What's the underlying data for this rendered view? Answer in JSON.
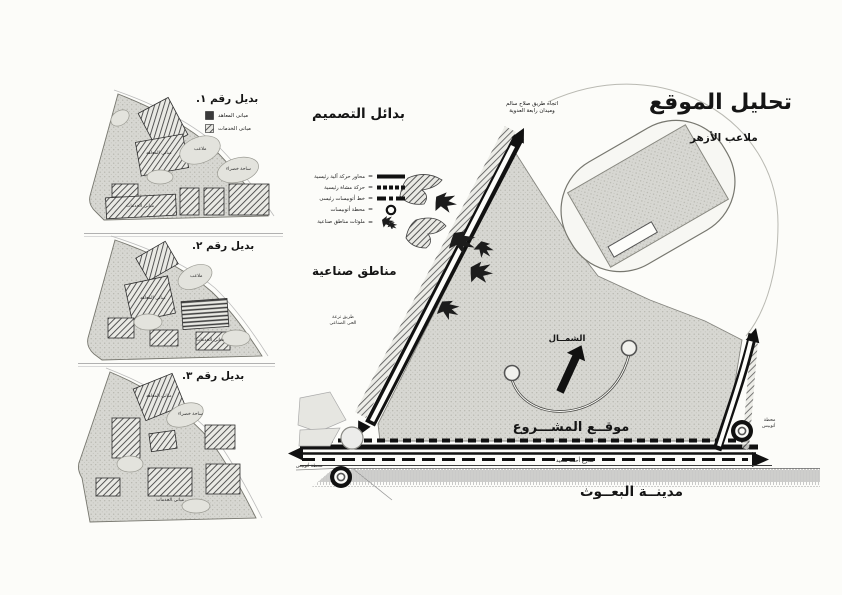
{
  "main_map": {
    "title": "تحليل الموقع",
    "stadium_label": "ملاعب الأزهر",
    "top_direction_note": [
      "اتجاه طريق صلاح سالم",
      "وميدان رابعة العدوية"
    ],
    "industrial_area_label": "مناطق صناعية",
    "industrial_road_note": [
      "طريق ترعة",
      "الحى الصناعى"
    ],
    "north_label": "الشمــال",
    "project_site_label": "موقــع المشـــروع",
    "bottom_road_label": "شارع أحمد سعيد",
    "bohooth_city_label": "مدينــة البعــوث",
    "bus_stop_right_note": [
      "محطة",
      "أتوبيس"
    ],
    "bus_stop_left_note": "محطة أتوبيس"
  },
  "design_legend": {
    "title": "بدائل التصميم",
    "equals": "=",
    "items": [
      {
        "label": "محاور حركة آلية رئيسية",
        "symbol": "solid-bar"
      },
      {
        "label": "حركة مشاة رئيسية",
        "symbol": "dashed-bar"
      },
      {
        "label": "خط أتوبيسات رئيسى",
        "symbol": "dash-dot-bar"
      },
      {
        "label": "محطة أتوبيسات",
        "symbol": "double-circle"
      },
      {
        "label": "ملوثات مناطق صناعية",
        "symbol": "sketch-arrows"
      }
    ]
  },
  "alternatives": [
    {
      "title": "بديل رقم ١.",
      "legend": [
        {
          "label": "مبانى المعاهد",
          "symbol": "solid-square"
        },
        {
          "label": "مبانى الخدمات",
          "symbol": "hatched-square"
        }
      ],
      "micro_labels": [
        "مبانى المعاهد",
        "ملاعب",
        "ساحة خضراء",
        "مبانى الخدمات"
      ]
    },
    {
      "title": "بديل رقم ٢.",
      "micro_labels": [
        "مبانى المعاهد",
        "ملاعب",
        "مبانى الخدمات"
      ]
    },
    {
      "title": "بديل رقم ٣.",
      "micro_labels": [
        "مبانى المعاهد",
        "ساحة خضراء",
        "مبانى الخدمات"
      ]
    }
  ],
  "colors": {
    "paper": "#fcfcf9",
    "site_fill": "#d7d7d2",
    "ink": "#111111",
    "line_gray": "#8a8a85"
  }
}
